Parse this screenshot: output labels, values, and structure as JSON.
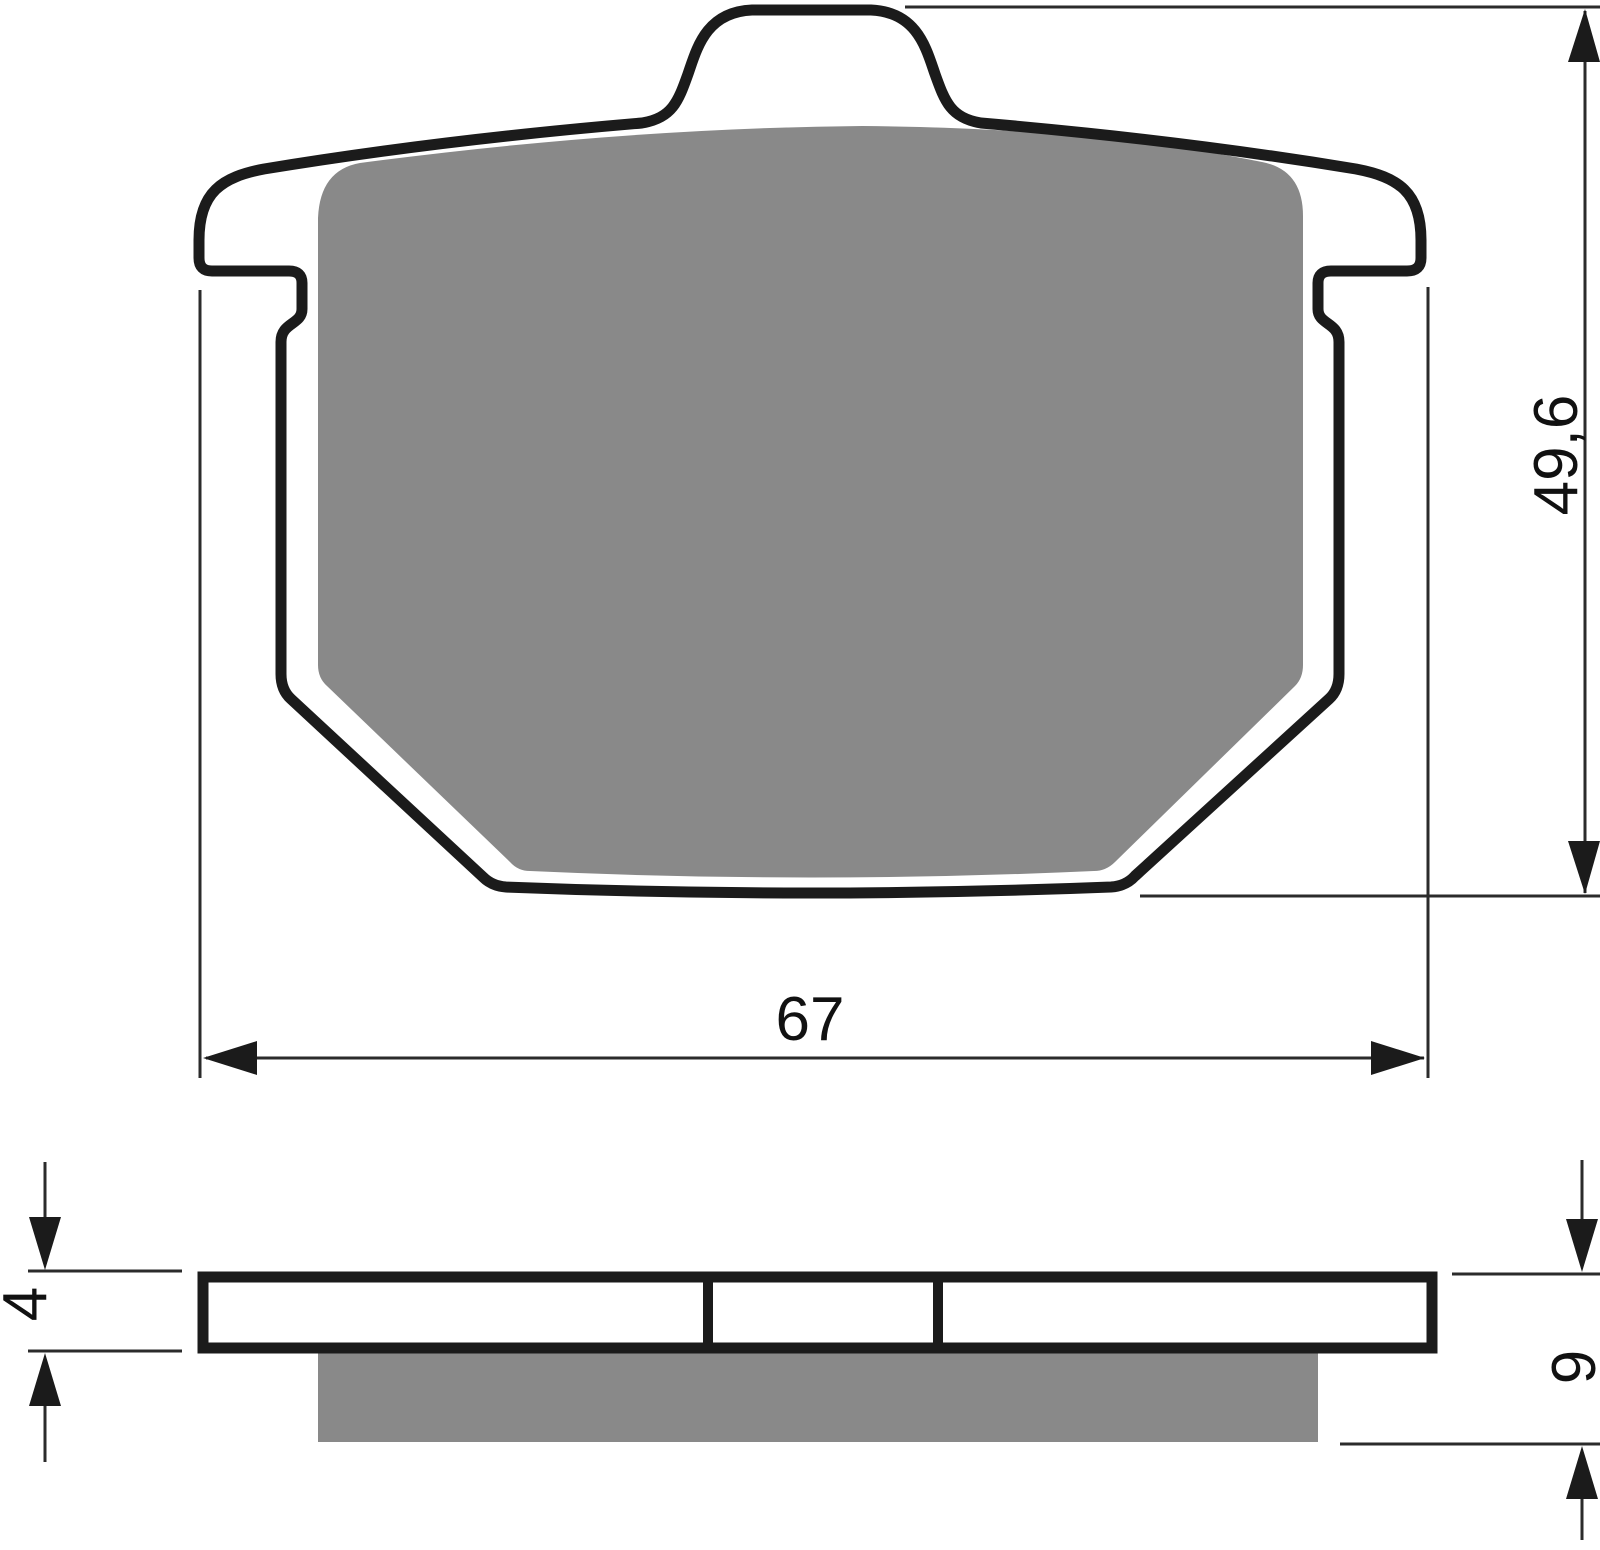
{
  "colors": {
    "background": "#ffffff",
    "outline": "#1b1b1b",
    "friction_gray": "#898989",
    "backplate_fill": "#ffffff",
    "dimension_line": "#2b2b2b",
    "arrow_fill": "#1b1b1b",
    "text": "#111111"
  },
  "dimensions": {
    "width_mm": "67",
    "height_mm": "49,6",
    "backplate_thickness_mm": "4",
    "total_thickness_mm": "9"
  }
}
